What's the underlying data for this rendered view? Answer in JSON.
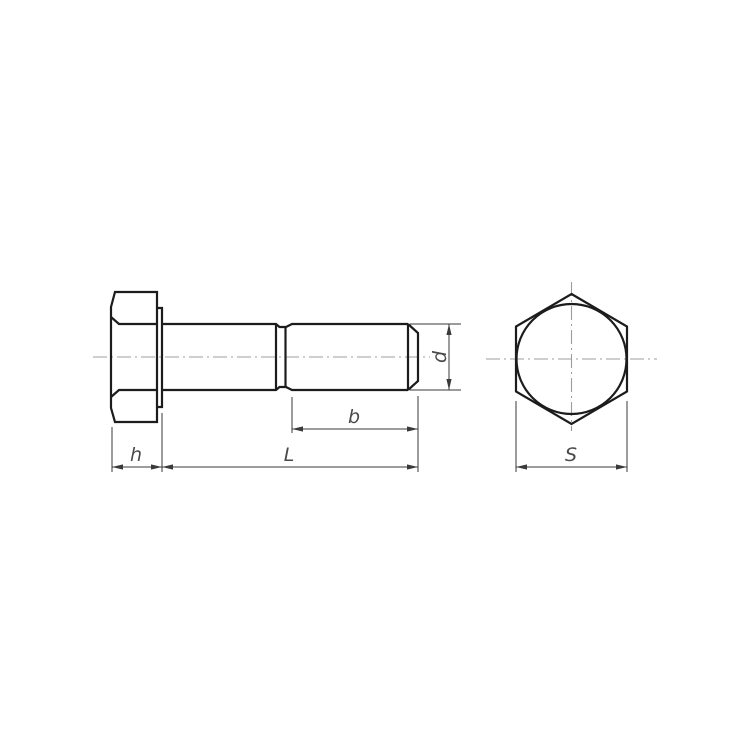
{
  "labels": {
    "head_height": "h",
    "bolt_length": "L",
    "thread_length": "b",
    "diameter": "d",
    "width_across_flats": "S"
  },
  "colors": {
    "background": "#ffffff",
    "outline": "#1c1c1c",
    "dimension_lines": "#3a3a3a",
    "centerline": "#9c9c9c",
    "label_text": "#4a4a4a"
  }
}
